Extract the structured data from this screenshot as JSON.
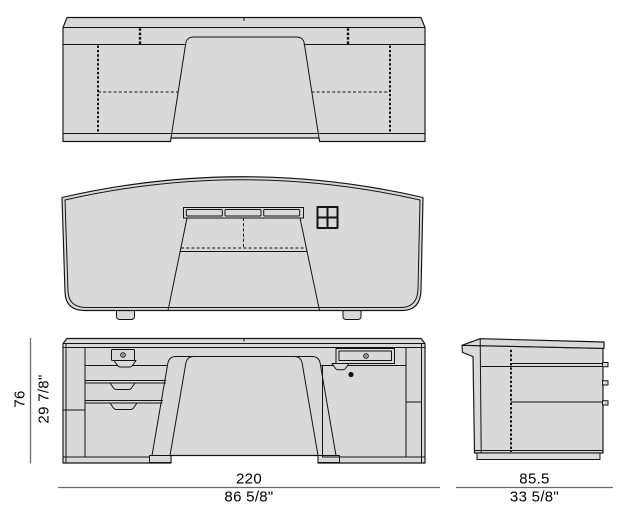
{
  "drawing": {
    "dimensions": {
      "height": {
        "cm": "76",
        "inch": "29 7/8\""
      },
      "width": {
        "cm": "220",
        "inch": "86 5/8\""
      },
      "depth": {
        "cm": "85.5",
        "inch": "33 5/8\""
      }
    },
    "colors": {
      "background": "#ffffff",
      "surface_fill": "#d9d9d9",
      "outline": "#141414",
      "dimension_line": "#6a6a6a",
      "text": "#000000"
    }
  }
}
